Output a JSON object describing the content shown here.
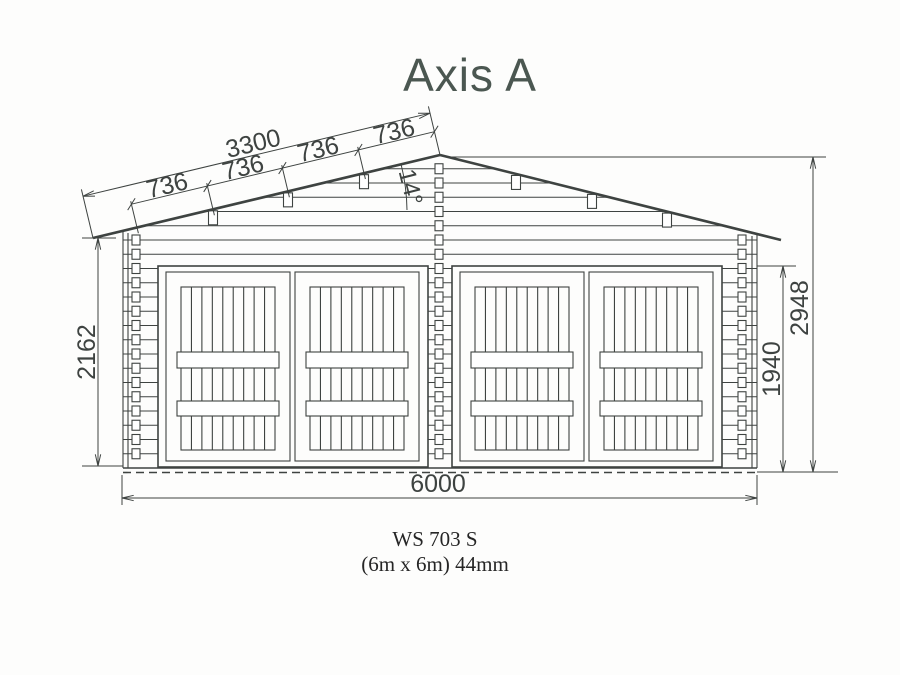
{
  "title": "Axis A",
  "drawing": {
    "dimensions": {
      "slope_total": "3300",
      "purlin_spacing": [
        "736",
        "736",
        "736",
        "736"
      ],
      "roof_angle": "14°",
      "left_wall_height": "2162",
      "right_wall_height": "1940",
      "ridge_height": "2948",
      "total_width": "6000"
    }
  },
  "footer": {
    "model": "WS 703 S",
    "size": "(6m x 6m) 44mm"
  },
  "colors": {
    "line": "#3e4341",
    "title": "#4b5751",
    "text": "#262626",
    "background": "#fdfdfc"
  }
}
